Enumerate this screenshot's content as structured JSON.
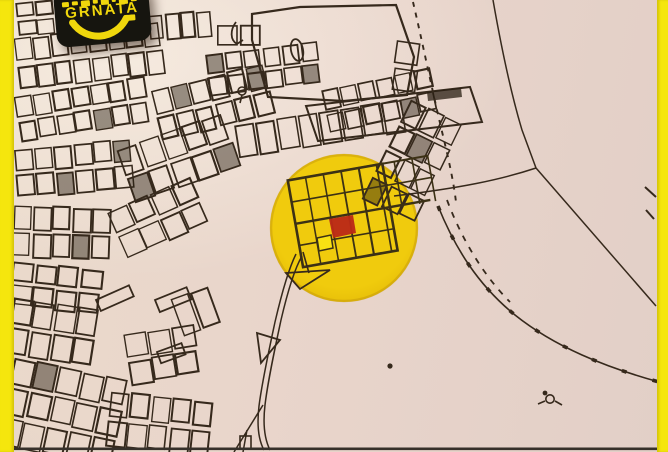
{
  "brand": {
    "name": "GRNATA",
    "logo_bg": "#16150f",
    "logo_accent": "#f0d70c"
  },
  "frame": {
    "left_bar_color": "#f5e60d",
    "right_bar_color": "#f5e60d"
  },
  "map": {
    "type": "cadastral-plot-map",
    "background": "#e9d6cb",
    "ink": "#36291c",
    "grid_ink": "#3c3115",
    "highlight_circle": {
      "color_inner": "#f0cb0d",
      "color_outer": "#e5bc08",
      "rim": "#c2950a",
      "cx": 344,
      "cy": 228,
      "r": 74
    },
    "plot_marker": {
      "color": "#ba2a17"
    },
    "highlight_cell": {
      "color": "#f8e113"
    },
    "bottom_border_color": "#36302a"
  }
}
